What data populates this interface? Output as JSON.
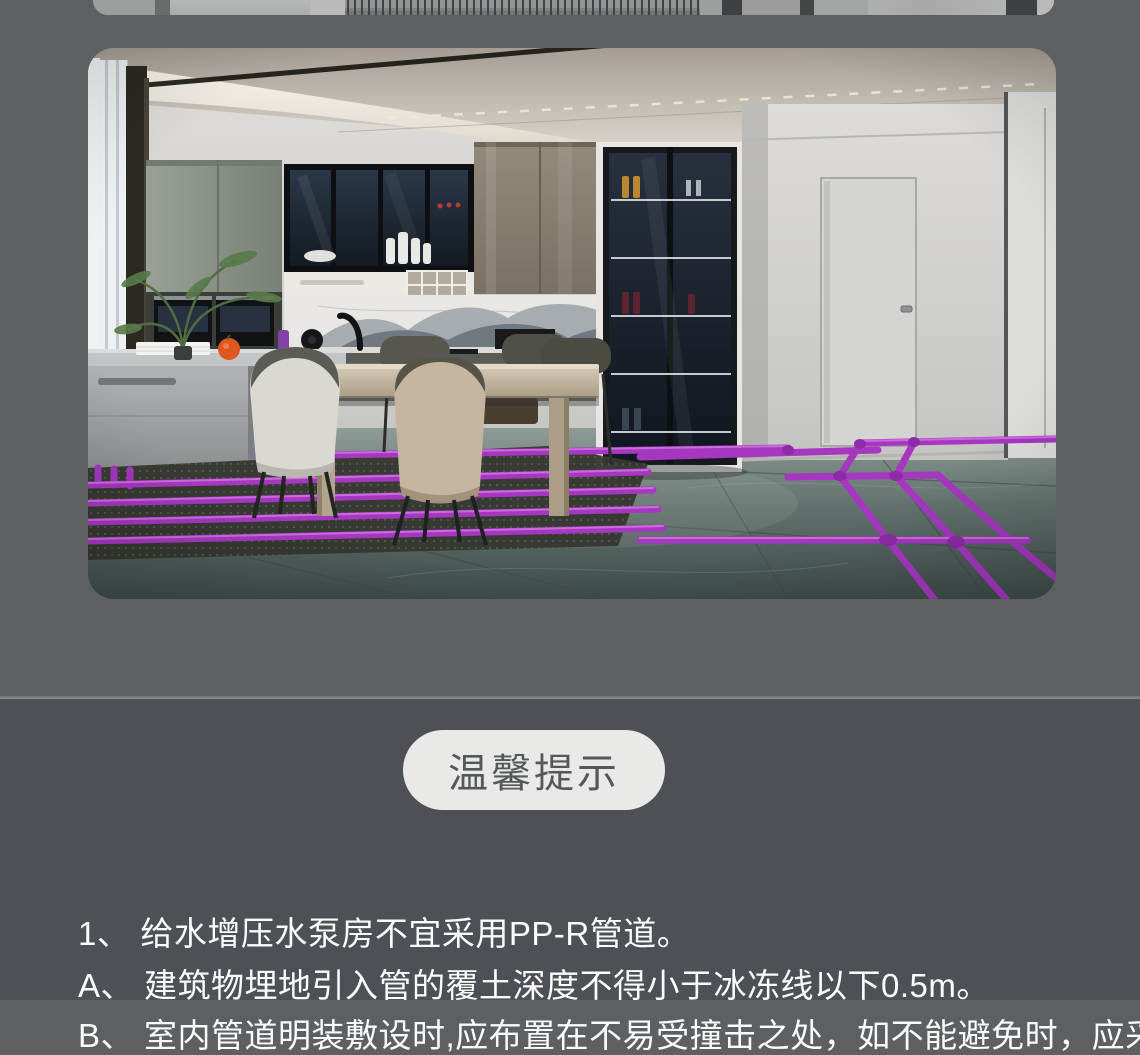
{
  "page": {
    "background_upper": "#5c6063",
    "background_lower": "#4d5155",
    "divider_color": "#7b7f82"
  },
  "media": {
    "top_fragment": "bottom edge of previous gallery image",
    "main_image": "kitchen rendering with purple PP-R pipe layout on floor",
    "pipe_color": "#a637c1",
    "pipe_highlight": "#d77fe6"
  },
  "tips_card": {
    "badge_label": "温馨提示",
    "badge_bg": "#e9eae7",
    "badge_text_color": "#54585b",
    "text_color": "#fbfbfb",
    "lines": [
      {
        "prefix": "1、",
        "text": "给水增压水泵房不宜采用PP-R管道。"
      },
      {
        "prefix": "A、",
        "text": "建筑物埋地引入管的覆土深度不得小于冰冻线以下0.5m。"
      },
      {
        "prefix": "B、",
        "text": "室内管道明装敷设时,应布置在不易受撞击之处，如不能避免时，应采取保护"
      }
    ]
  }
}
